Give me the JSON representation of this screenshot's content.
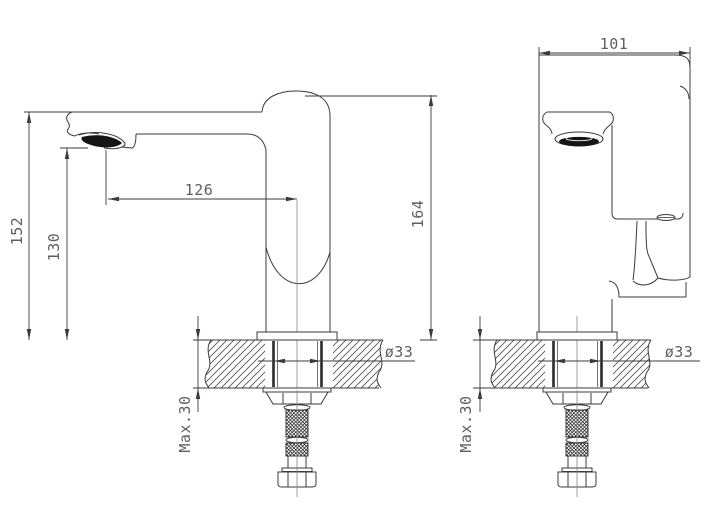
{
  "canvas": {
    "background": "#ffffff",
    "line_color": "#3b3b3b",
    "text_color": "#5e5e5e",
    "fill_dark": "#151515"
  },
  "views": {
    "side_view_name": "faucet-side-profile-view",
    "front_view_name": "faucet-front-view"
  },
  "dimensions": {
    "spout_height": "152",
    "outlet_height": "130",
    "spout_reach": "126",
    "overall_height": "164",
    "body_width": "101",
    "hole_dia_side": "ø33",
    "hole_dia_front": "ø33",
    "max_deck_side": "Max.30",
    "max_deck_front": "Max.30"
  }
}
